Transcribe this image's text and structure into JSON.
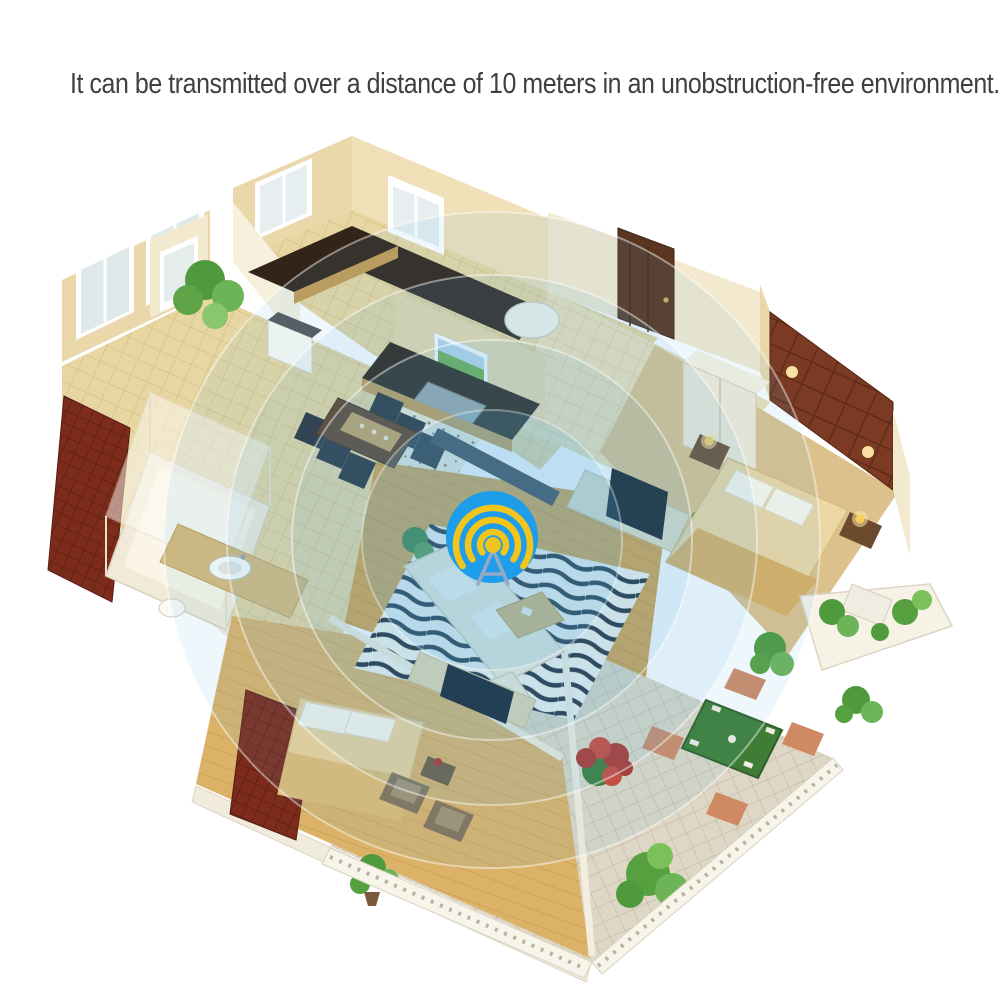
{
  "caption": {
    "text": "It can be transmitted over a distance of 10 meters in an unobstruction-free environment."
  },
  "signal": {
    "center_x": 492,
    "center_y": 540,
    "ring_radii": [
      328,
      265,
      200,
      130
    ],
    "ring_color": "#57b4e6",
    "icon": {
      "name": "broadcast-beacon-icon",
      "circle_color": "#1d9dea",
      "wave_color": "#f2c51d",
      "tripod_color": "#93a9c4",
      "ball_color": "#f0c31f"
    }
  },
  "palette": {
    "background": "#ffffff",
    "text": "#3f3f3f",
    "wall": "#ead8ab",
    "wall_light": "#f3e9ce",
    "tile_floor": "#e7d6a2",
    "corridor_floor": "#eee0b8",
    "wood_floor": "#d7a148",
    "bedroom_wood": "#dcb269",
    "carpet": "#dcc18c",
    "patio_tile": "#ded7c5",
    "counter_dark": "#33241a",
    "cabinet_wood": "#c59a52",
    "door_brown": "#5a3620",
    "headboard_brown": "#7a3a24",
    "wardrobe_red": "#7d2c1c",
    "sofa_white": "#f3eddb",
    "bed_tan": "#ecd6a4",
    "plant_green": "#57a03f",
    "patio_table_green": "#3f7d36",
    "flower_red": "#b23226",
    "rug_stripe": "#1f2833",
    "railing_white": "#f7f4ea"
  }
}
